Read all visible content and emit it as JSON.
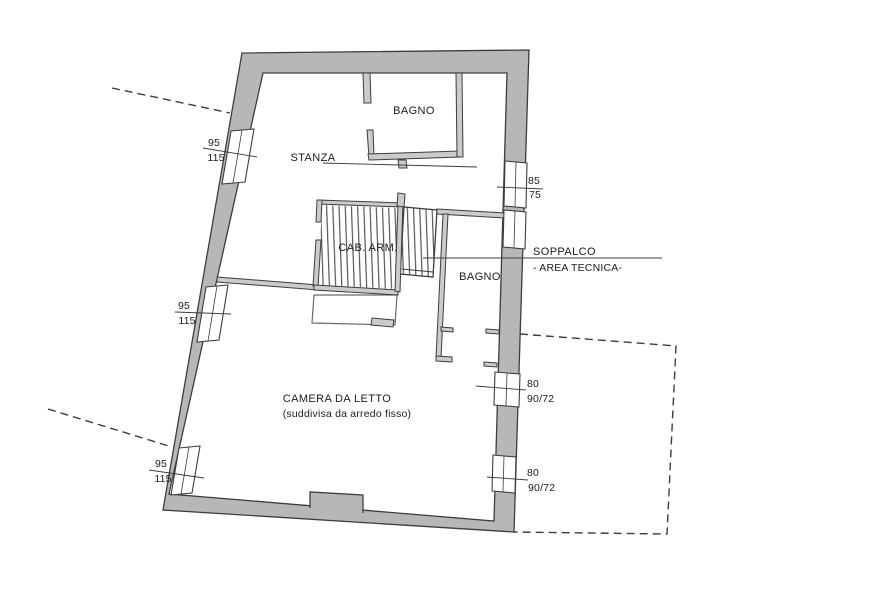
{
  "colors": {
    "background": "#ffffff",
    "text": "#1c1c1c",
    "wall_fill": "#b7b7b7",
    "wall_outline": "#3d3d3d",
    "interior_wall_fill": "#cbcbcb",
    "hatch_dark": "#4f4f4f",
    "hatch_red_line": "#dc9b9b",
    "hatch_red_fill": "#faeaea",
    "dashed_line": "#3d3d3d"
  },
  "rooms": {
    "stanza": {
      "label": "STANZA"
    },
    "bagno_top": {
      "label": "BAGNO"
    },
    "cab_arm": {
      "label": "CAB. ARM."
    },
    "bagno_lower": {
      "label": "BAGNO"
    },
    "soppalco": {
      "label": "SOPPALCO",
      "sublabel": "- AREA TECNICA-"
    },
    "camera": {
      "label": "CAMERA DA LETTO",
      "sublabel": "(suddivisa da arredo fisso)"
    }
  },
  "dimensions": {
    "window_left_top": {
      "top": "95",
      "bottom": "115"
    },
    "window_left_mid": {
      "top": "95",
      "bottom": "115"
    },
    "window_left_bottom": {
      "top": "95",
      "bottom": "115"
    },
    "window_right_top": {
      "top": "85",
      "bottom": "75"
    },
    "window_right_mid": {
      "top": "80",
      "bottom": "90/72"
    },
    "window_right_bottom": {
      "top": "80",
      "bottom": "90/72"
    }
  }
}
